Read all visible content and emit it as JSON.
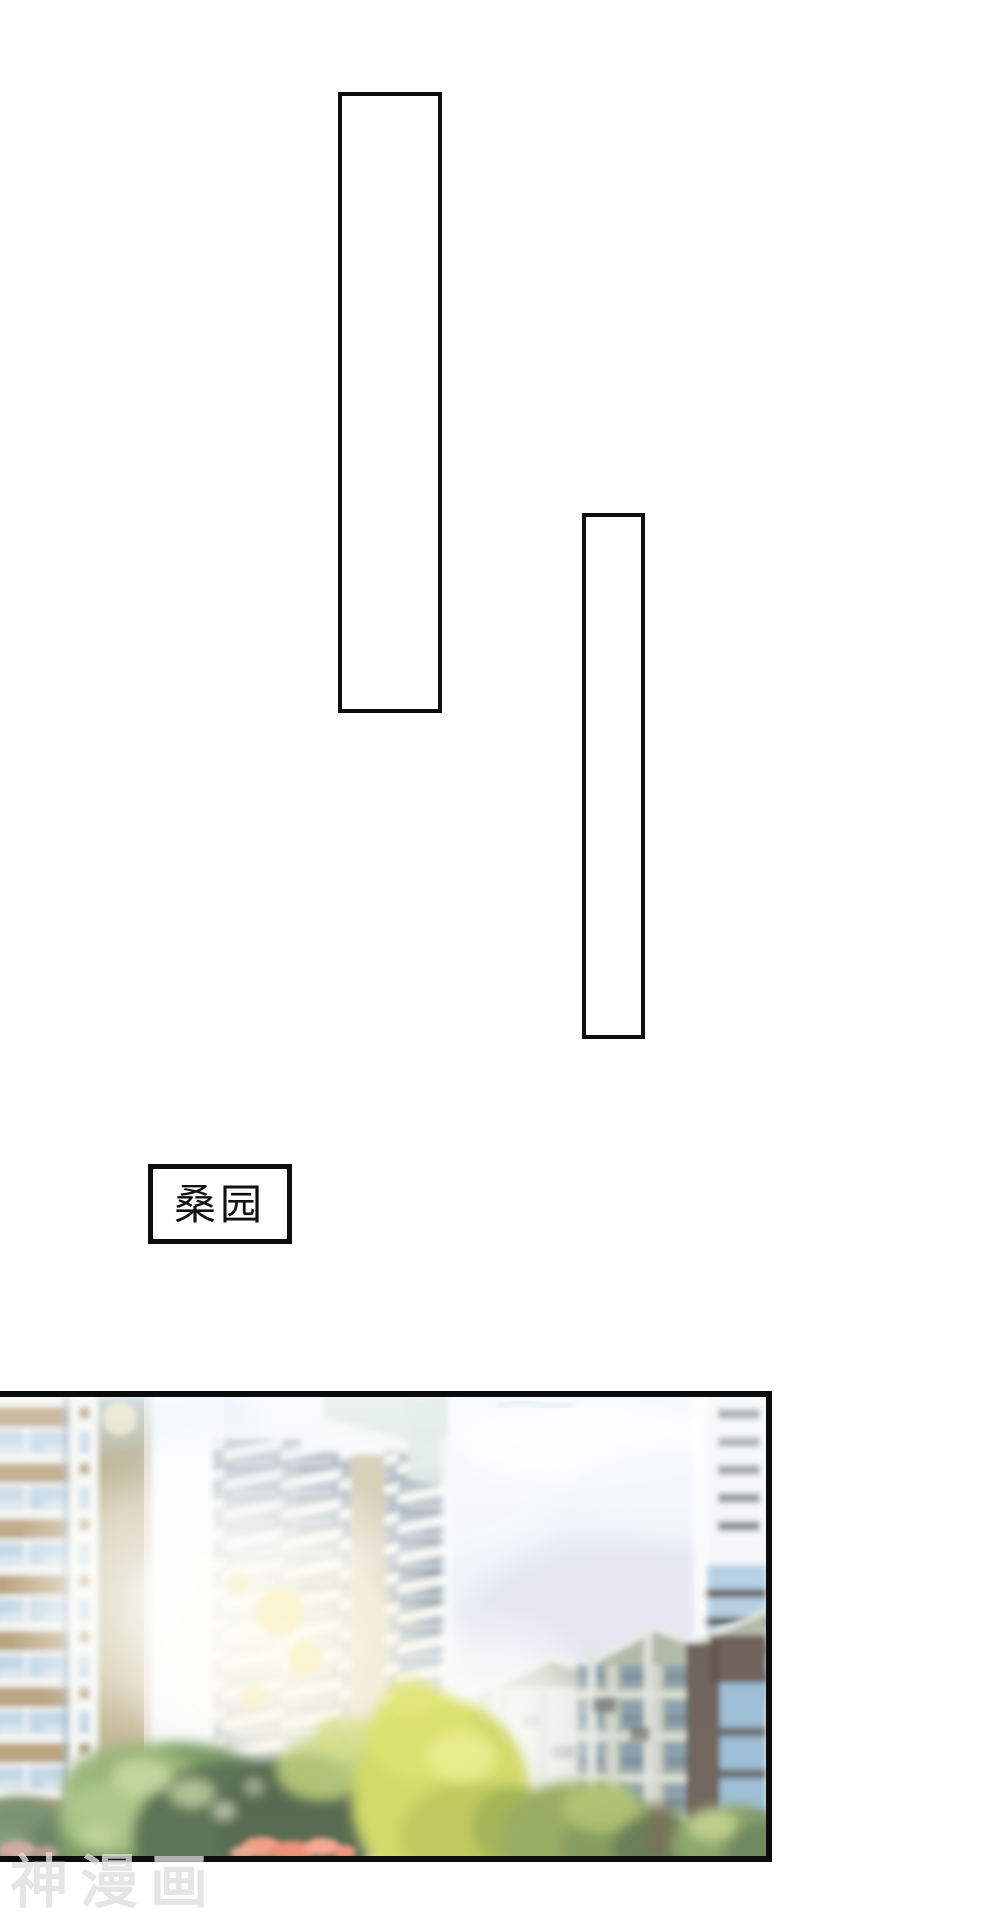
{
  "comic": {
    "speech_bubbles": [
      {
        "id": "bubble-1",
        "text": ""
      },
      {
        "id": "bubble-2",
        "text": ""
      }
    ],
    "location_label": {
      "text": "桑园"
    },
    "watermark": {
      "text": "神漫画",
      "color": "#dfdfdf"
    }
  },
  "illustration": {
    "name": "sunlit-apartment-complex",
    "palette": {
      "sky": "#eef5fa",
      "sky_lavender": "#e1e3ee",
      "building_tan": "#b49b72",
      "building_olive": "#a89468",
      "balcony_white": "#f2f4f1",
      "window_blue": "#bdd3e4",
      "window_slate": "#5d6b76",
      "right_wall": "#aab2a0",
      "right_glass": "#9cc2de",
      "dark_brown": "#5a4a40",
      "tree_bright": "#ccd556",
      "tree_green": "#6f9254",
      "tree_dark": "#435c3e",
      "flower_coral": "#ef9478",
      "sun_glow": "#fdf6d0"
    }
  },
  "ink": "#0d0d0d",
  "paper": "#ffffff"
}
